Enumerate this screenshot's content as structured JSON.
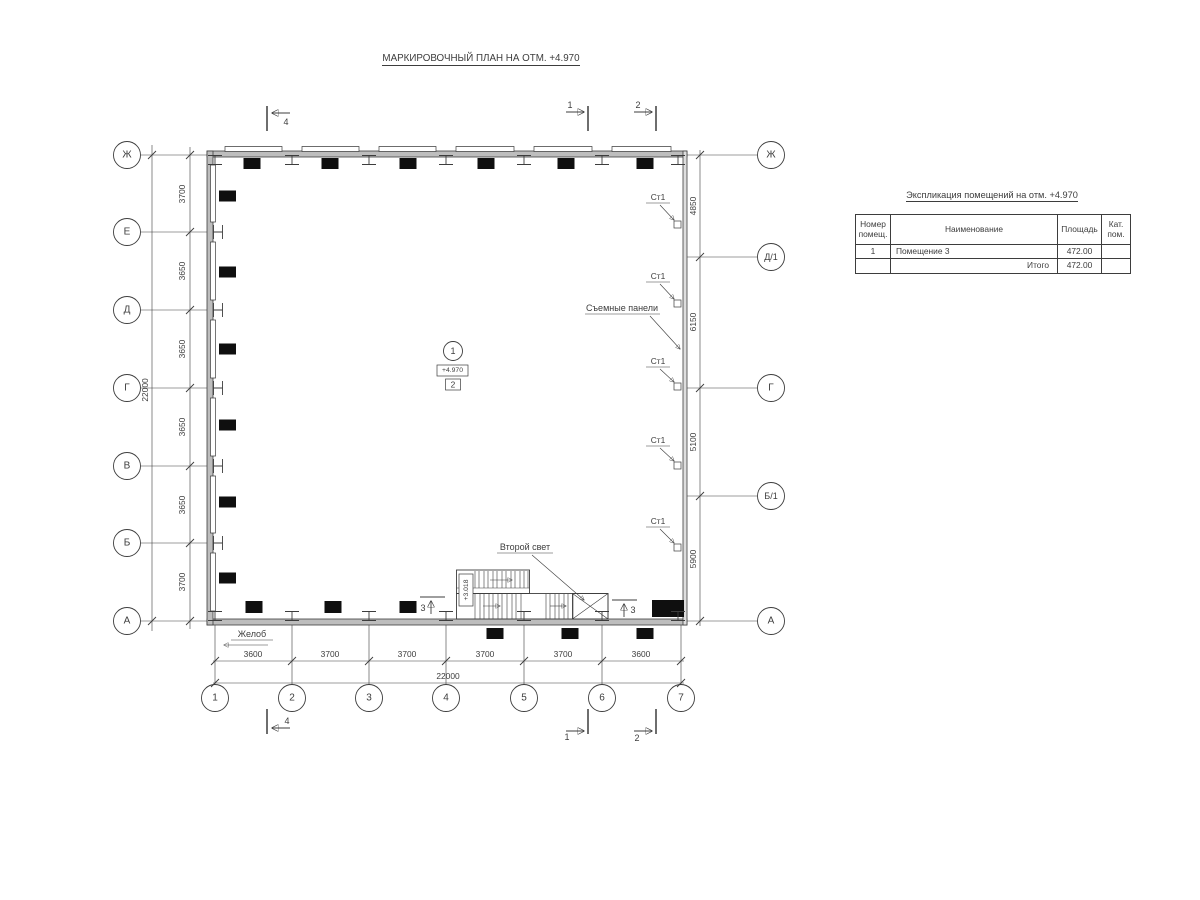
{
  "title": "МАРКИРОВОЧНЫЙ ПЛАН НА ОТМ. +4.970",
  "schedule": {
    "title": "Экспликация помещений на отм. +4.970",
    "col_num": "Номер помещ.",
    "col_name": "Наименование",
    "col_area": "Площадь",
    "col_cat": "Кат. пом.",
    "row1_num": "1",
    "row1_name": "Помещение 3",
    "row1_area": "472.00",
    "row1_cat": "",
    "total_label": "Итого",
    "total_area": "472.00"
  },
  "axes": {
    "left": [
      "Ж",
      "Е",
      "Д",
      "Г",
      "В",
      "Б",
      "А"
    ],
    "right": [
      "Ж",
      "Д/1",
      "Г",
      "Б/1",
      "А"
    ],
    "bottom": [
      "1",
      "2",
      "3",
      "4",
      "5",
      "6",
      "7"
    ]
  },
  "dims": {
    "left": [
      "3700",
      "3650",
      "3650",
      "3650",
      "3650",
      "3700"
    ],
    "left_total": "22000",
    "right": [
      "4850",
      "6150",
      "5100",
      "5900"
    ],
    "bottom": [
      "3600",
      "3700",
      "3700",
      "3700",
      "3700",
      "3600"
    ],
    "bottom_total": "22000"
  },
  "marker": {
    "number": "1",
    "elevation": "+4.970",
    "tag": "2"
  },
  "labels": {
    "st1": "Ст1",
    "panels": "Съемные панели",
    "second_light": "Второй свет",
    "gutter": "Желоб",
    "stair_elev": "+3.018"
  },
  "sections": {
    "s1": "1",
    "s2": "2",
    "s3": "3",
    "s4": "4"
  },
  "colors": {
    "line": "#3d3d3d",
    "wall_fill": "#bdbdbd",
    "panel_black": "#0f0f0f"
  }
}
